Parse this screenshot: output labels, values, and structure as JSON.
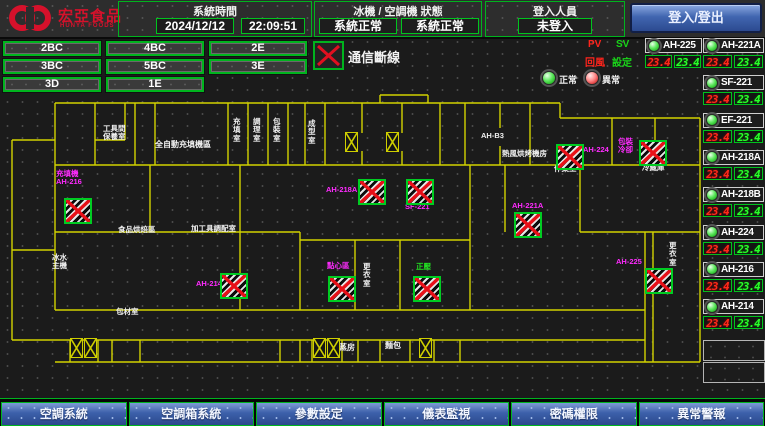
{
  "header": {
    "logo": {
      "brand_cn": "宏亞食品",
      "brand_en": "HUNYA FOODS",
      "color": "#d6112b"
    },
    "system_time": {
      "label": "系統時間",
      "date": "2024/12/12",
      "time": "22:09:51"
    },
    "machine_status": {
      "label": "冰機 / 空調機 狀態",
      "status1": "系統正常",
      "status2": "系統正常"
    },
    "login": {
      "label": "登入人員",
      "value": "未登入",
      "button_label": "登入/登出"
    }
  },
  "floor_buttons": [
    "2BC",
    "4BC",
    "2E",
    "3BC",
    "5BC",
    "3E",
    "3D",
    "1E"
  ],
  "legend": {
    "comm_loss": "通信斷線",
    "pv": "PV",
    "sv": "SV",
    "pv_sub": "回風",
    "sv_sub": "設定",
    "normal": "正常",
    "abnormal": "異常"
  },
  "units_left": [
    {
      "name": "AH-225",
      "pv": "23.4",
      "sv": "23.4",
      "lamp": "green"
    }
  ],
  "units_right": [
    {
      "name": "AH-221A",
      "pv": "23.4",
      "sv": "23.4",
      "lamp": "green"
    },
    {
      "name": "SF-221",
      "pv": "23.4",
      "sv": "23.4",
      "lamp": "green"
    },
    {
      "name": "EF-221",
      "pv": "23.4",
      "sv": "23.4",
      "lamp": "green"
    },
    {
      "name": "AH-218A",
      "pv": "23.4",
      "sv": "23.4",
      "lamp": "green"
    },
    {
      "name": "AH-218B",
      "pv": "23.4",
      "sv": "23.4",
      "lamp": "green"
    },
    {
      "name": "AH-224",
      "pv": "23.4",
      "sv": "23.4",
      "lamp": "green"
    },
    {
      "name": "AH-216",
      "pv": "23.4",
      "sv": "23.4",
      "lamp": "green"
    },
    {
      "name": "AH-214",
      "pv": "23.4",
      "sv": "23.4",
      "lamp": "green"
    }
  ],
  "empty_slots": 2,
  "floorplan": {
    "labels": [
      {
        "t": "冰水\n主機",
        "x": 52,
        "y": 254,
        "c": "w"
      },
      {
        "t": "工具間\n保養室",
        "x": 103,
        "y": 125,
        "c": "w"
      },
      {
        "t": "全自動充填機區",
        "x": 155,
        "y": 141,
        "c": "w",
        "fs": 8
      },
      {
        "t": "充\n填\n室",
        "x": 233,
        "y": 118,
        "c": "w"
      },
      {
        "t": "調\n理\n室",
        "x": 253,
        "y": 118,
        "c": "w"
      },
      {
        "t": "包\n裝\n室",
        "x": 273,
        "y": 118,
        "c": "w"
      },
      {
        "t": "成\n型\n室",
        "x": 308,
        "y": 120,
        "c": "w"
      },
      {
        "t": "AH-B3",
        "x": 481,
        "y": 132,
        "c": "w"
      },
      {
        "t": "熱風烘烤機房",
        "x": 502,
        "y": 150,
        "c": "w"
      },
      {
        "t": "作業室",
        "x": 554,
        "y": 165,
        "c": "w"
      },
      {
        "t": "冷藏庫",
        "x": 642,
        "y": 164,
        "c": "w"
      },
      {
        "t": "食品烘焙區",
        "x": 118,
        "y": 226,
        "c": "w"
      },
      {
        "t": "加工具調配室",
        "x": 191,
        "y": 225,
        "c": "w"
      },
      {
        "t": "更\n衣\n室",
        "x": 363,
        "y": 263,
        "c": "w"
      },
      {
        "t": "包材室",
        "x": 116,
        "y": 308,
        "c": "w"
      },
      {
        "t": "蒸房",
        "x": 339,
        "y": 344,
        "c": "w",
        "fs": 8
      },
      {
        "t": "麵包",
        "x": 385,
        "y": 342,
        "c": "w",
        "fs": 8
      },
      {
        "t": "更\n衣\n室",
        "x": 669,
        "y": 242,
        "c": "w"
      },
      {
        "t": "充填機\nAH-216",
        "x": 56,
        "y": 170,
        "c": "m"
      },
      {
        "t": "AH-218A",
        "x": 326,
        "y": 186,
        "c": "m"
      },
      {
        "t": "SF-221",
        "x": 405,
        "y": 203,
        "c": "m"
      },
      {
        "t": "AH-214",
        "x": 196,
        "y": 280,
        "c": "m"
      },
      {
        "t": "點心區",
        "x": 327,
        "y": 262,
        "c": "m"
      },
      {
        "t": "正壓",
        "x": 416,
        "y": 263,
        "c": "g"
      },
      {
        "t": "AH-221A",
        "x": 512,
        "y": 202,
        "c": "m"
      },
      {
        "t": "AH-224",
        "x": 583,
        "y": 146,
        "c": "m"
      },
      {
        "t": "包裝\n冷卻",
        "x": 618,
        "y": 138,
        "c": "m"
      },
      {
        "t": "AH-225",
        "x": 616,
        "y": 258,
        "c": "m"
      }
    ],
    "alarms": [
      {
        "x": 64,
        "y": 198
      },
      {
        "x": 220,
        "y": 273
      },
      {
        "x": 328,
        "y": 276
      },
      {
        "x": 413,
        "y": 276
      },
      {
        "x": 358,
        "y": 179
      },
      {
        "x": 406,
        "y": 179
      },
      {
        "x": 556,
        "y": 144
      },
      {
        "x": 639,
        "y": 140
      },
      {
        "x": 514,
        "y": 212
      },
      {
        "x": 645,
        "y": 268
      }
    ],
    "doors": [
      {
        "x": 345,
        "y": 132
      },
      {
        "x": 386,
        "y": 132
      },
      {
        "x": 70,
        "y": 338
      },
      {
        "x": 84,
        "y": 338
      },
      {
        "x": 313,
        "y": 338
      },
      {
        "x": 327,
        "y": 338
      },
      {
        "x": 419,
        "y": 338
      }
    ]
  },
  "bottom_nav": [
    "空調系統",
    "空調箱系統",
    "參數設定",
    "儀表監視",
    "密碼權限",
    "異常警報"
  ]
}
